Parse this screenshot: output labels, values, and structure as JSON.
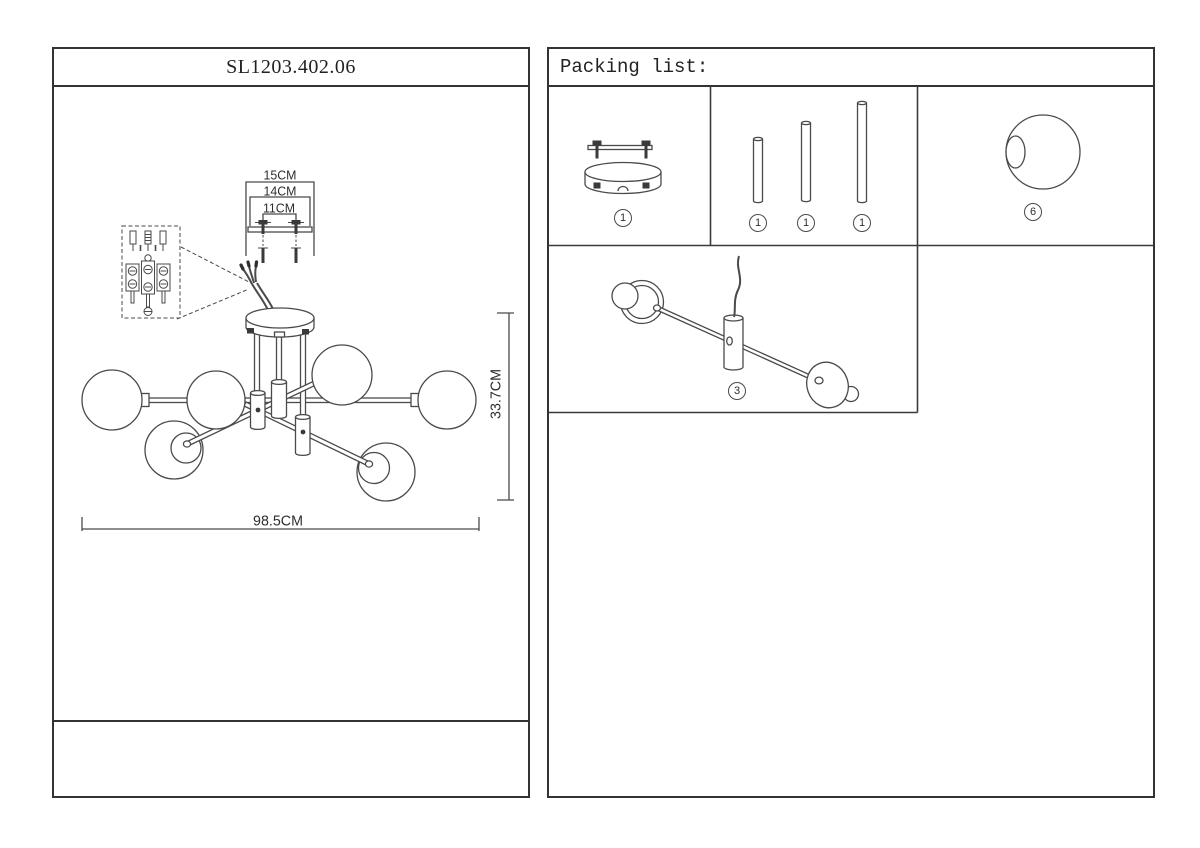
{
  "document": {
    "model_number": "SL1203.402.06",
    "packing_list": {
      "header": "Packing list:",
      "items": [
        {
          "name": "canopy-with-mounting-bar",
          "badge": "1"
        },
        {
          "name": "rod-short",
          "badge": "1"
        },
        {
          "name": "rod-medium",
          "badge": "1"
        },
        {
          "name": "rod-long",
          "badge": "1"
        },
        {
          "name": "glass-globe",
          "badge": "6"
        },
        {
          "name": "arm-with-sockets",
          "badge": "3"
        }
      ]
    },
    "dimensions": {
      "bracket_outer_width": "15CM",
      "canopy_width": "14CM",
      "screw_spacing": "11CM",
      "fixture_height": "33.7CM",
      "fixture_width": "98.5CM"
    },
    "colors": {
      "background": "#ffffff",
      "line": "#4a4a4a",
      "border": "#333333"
    }
  }
}
